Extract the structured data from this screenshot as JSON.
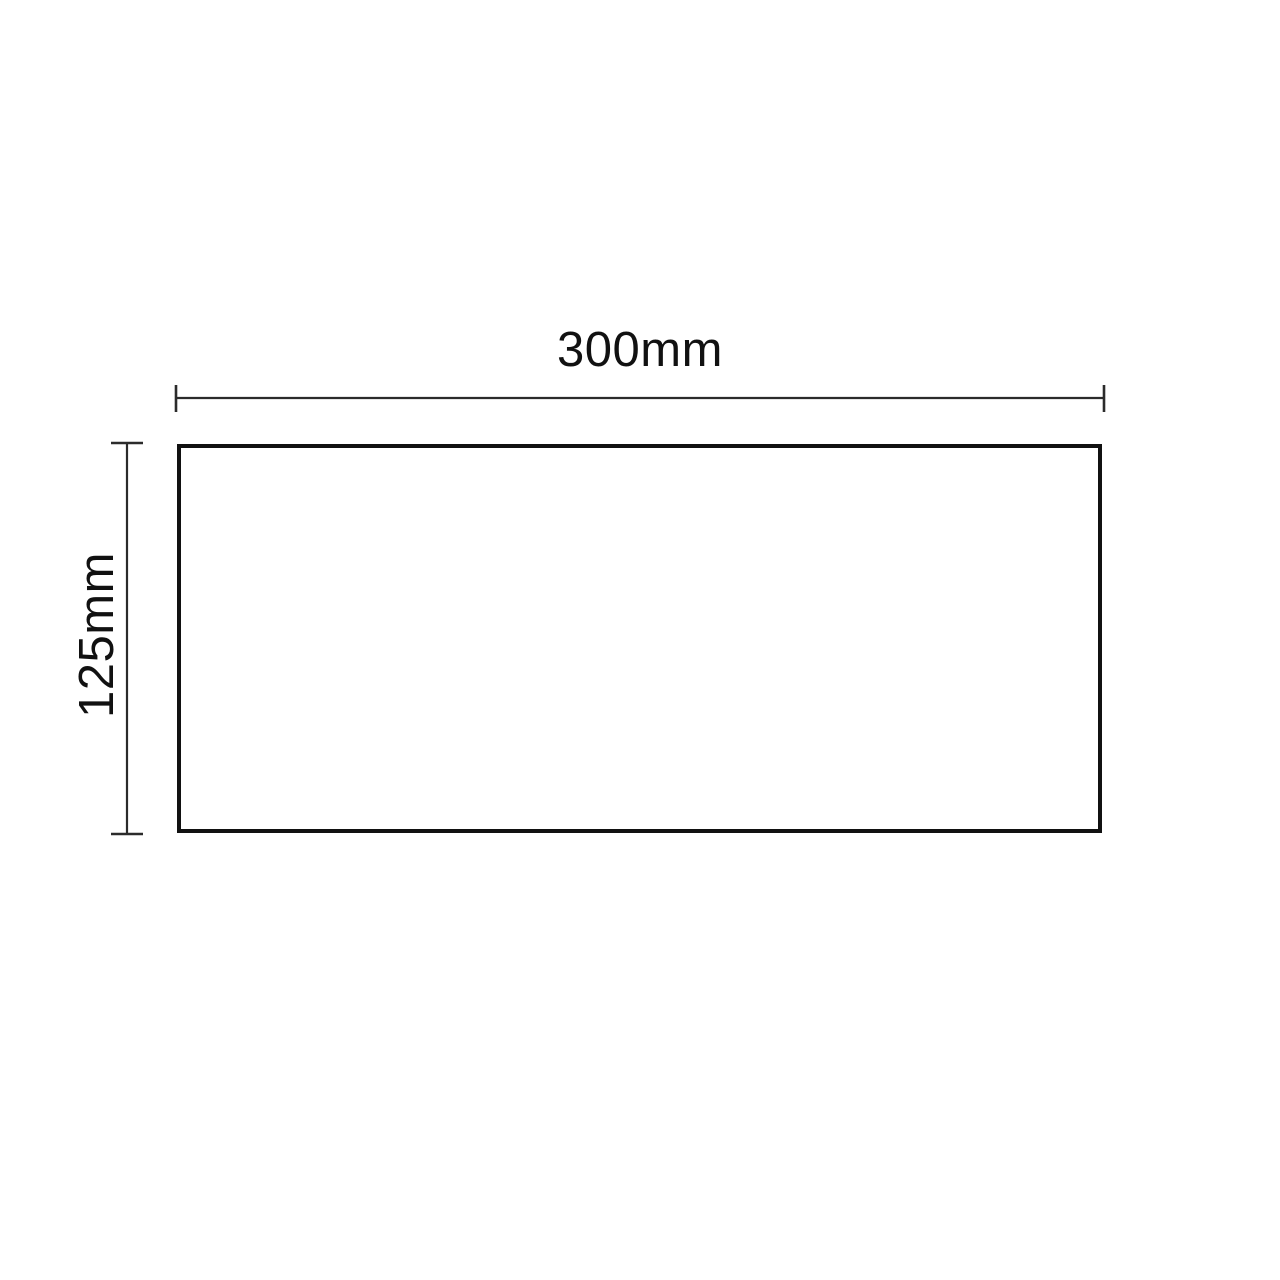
{
  "diagram": {
    "type": "dimensioned-rectangle-drawing",
    "width_dimension": {
      "label": "300mm",
      "value": 300,
      "unit": "mm"
    },
    "height_dimension": {
      "label": "125mm",
      "value": 125,
      "unit": "mm"
    },
    "colors": {
      "background": "#ffffff",
      "outline": "#111111",
      "dimension_line": "#2b2b2b",
      "text": "#111111"
    }
  }
}
